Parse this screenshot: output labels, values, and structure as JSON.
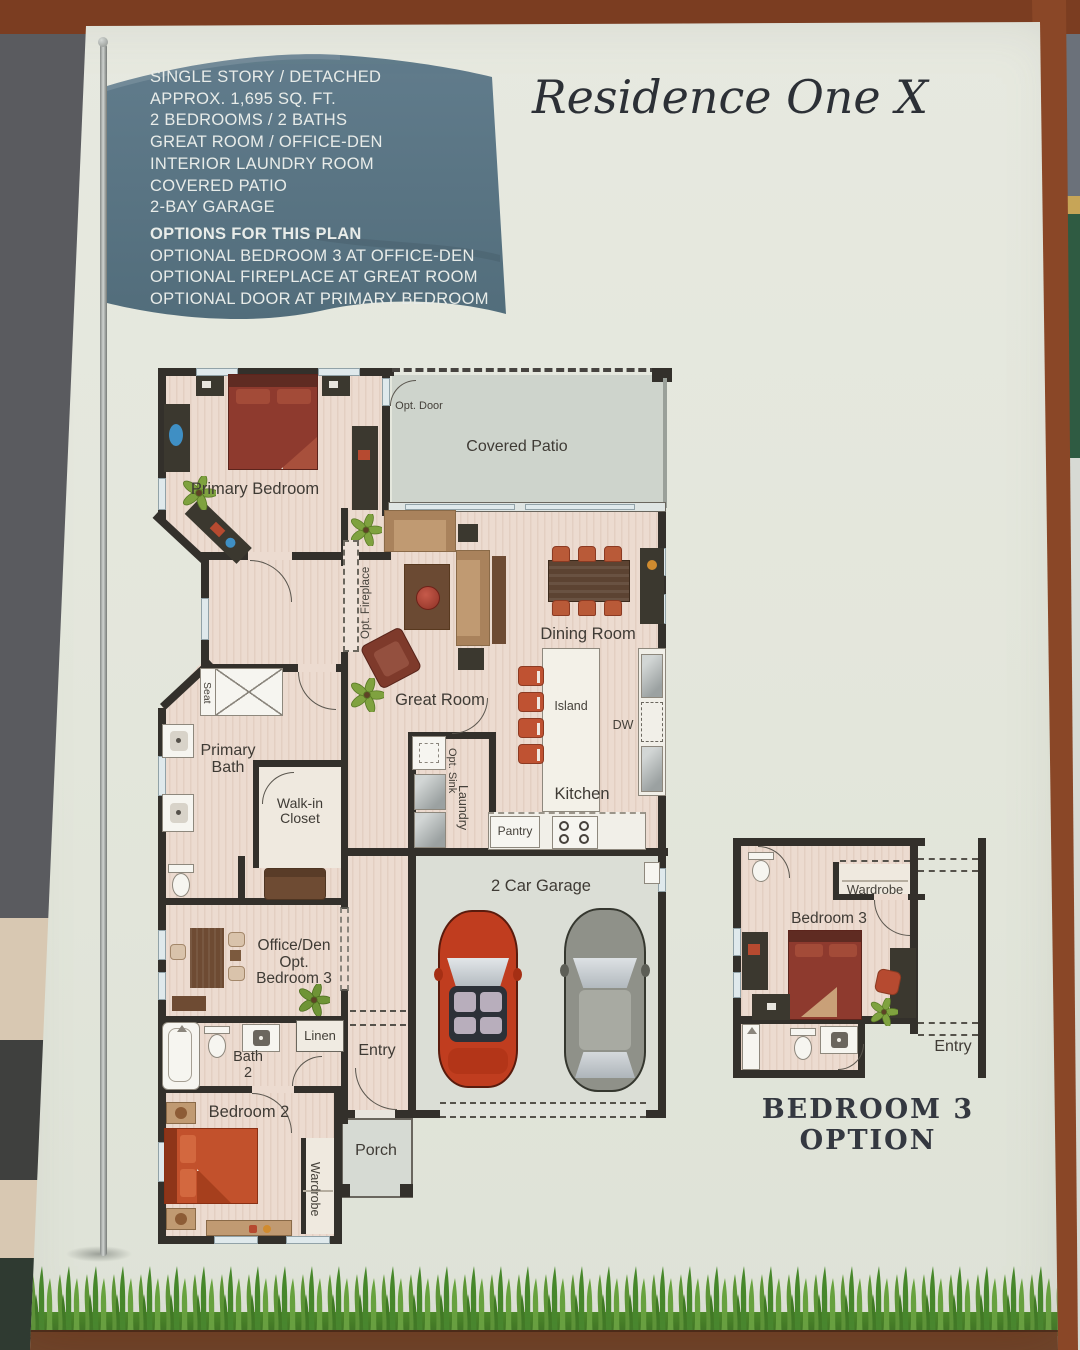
{
  "title": "Residence One X",
  "flag": {
    "features": [
      "SINGLE STORY / DETACHED",
      "APPROX. 1,695 SQ. FT.",
      "2 BEDROOMS / 2 BATHS",
      "GREAT ROOM / OFFICE-DEN",
      "INTERIOR LAUNDRY ROOM",
      "COVERED PATIO",
      "2-BAY GARAGE"
    ],
    "options_heading": "OPTIONS FOR THIS PLAN",
    "options": [
      "OPTIONAL BEDROOM 3 AT OFFICE-DEN",
      "OPTIONAL FIREPLACE AT GREAT ROOM",
      "OPTIONAL DOOR AT PRIMARY BEDROOM"
    ]
  },
  "plan": {
    "primary_bedroom": "Primary Bedroom",
    "opt_door": "Opt. Door",
    "covered_patio": "Covered Patio",
    "opt_fireplace": "Opt. Fireplace",
    "great_room": "Great Room",
    "dining_room": "Dining Room",
    "island": "Island",
    "dw": "DW",
    "kitchen": "Kitchen",
    "pantry": "Pantry",
    "laundry": "Laundry",
    "opt_sink": "Opt. Sink",
    "seat": "Seat",
    "primary_bath": "Primary\nBath",
    "walk_in_closet": "Walk-in\nCloset",
    "office_den": "Office/Den\nOpt.\nBedroom 3",
    "linen": "Linen",
    "bath_2": "Bath\n2",
    "bedroom_2": "Bedroom 2",
    "wardrobe": "Wardrobe",
    "entry": "Entry",
    "porch": "Porch",
    "garage": "2 Car Garage"
  },
  "inset": {
    "wardrobe": "Wardrobe",
    "bedroom_3": "Bedroom 3",
    "entry": "Entry",
    "caption": "BEDROOM 3 OPTION"
  },
  "colors": {
    "flag": "#5b7484",
    "flag_text": "#e8ece9",
    "wall": "#33302b",
    "floor_wood": "#ecdbd0",
    "patio_gray": "#ced4cc",
    "bed_red": "#8e3a2e",
    "bed_orange": "#c2512c",
    "accent_rust": "#bf5232",
    "page_background": "#e4e7dd",
    "grass_green": "#4c8a28",
    "dirt_brown": "#6d3a1e",
    "border_brown": "#8a4727"
  }
}
